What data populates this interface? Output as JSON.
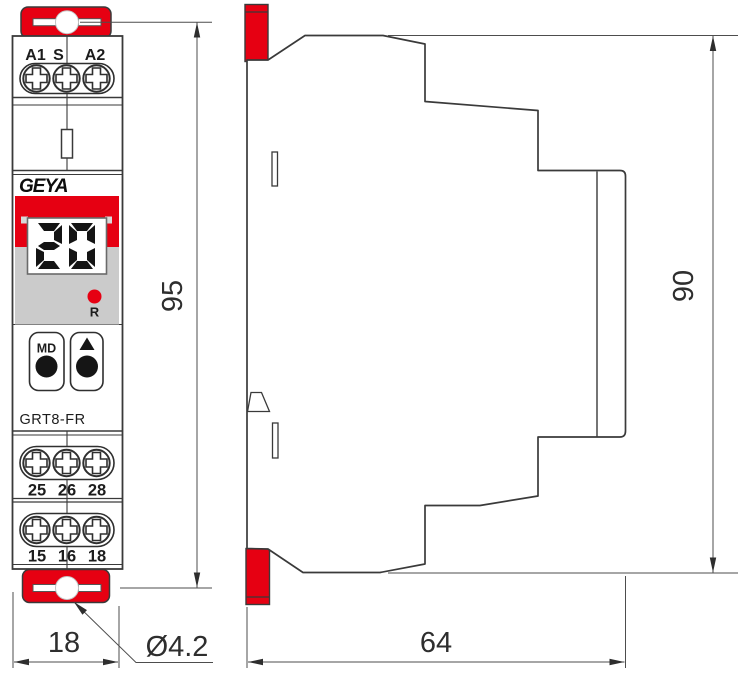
{
  "front_view": {
    "terminal_labels_top": [
      "A1",
      "S",
      "A2"
    ],
    "brand_logo": "GEYA",
    "lcd_value": "20",
    "reset_led_label": "R",
    "mode_button_label": "MD",
    "model_label": "GRT8-FR",
    "terminal_labels_middle": [
      "25",
      "26",
      "28"
    ],
    "terminal_labels_bottom": [
      "15",
      "16",
      "18"
    ]
  },
  "dimensions": {
    "front_height": "95",
    "front_width": "18",
    "side_height": "90",
    "side_depth": "64",
    "mounting_hole_diameter": "Ø4.2"
  },
  "colors": {
    "accent_red": "#e60012",
    "outline": "#3a3a3a",
    "display_gray": "#cbcbcb"
  }
}
